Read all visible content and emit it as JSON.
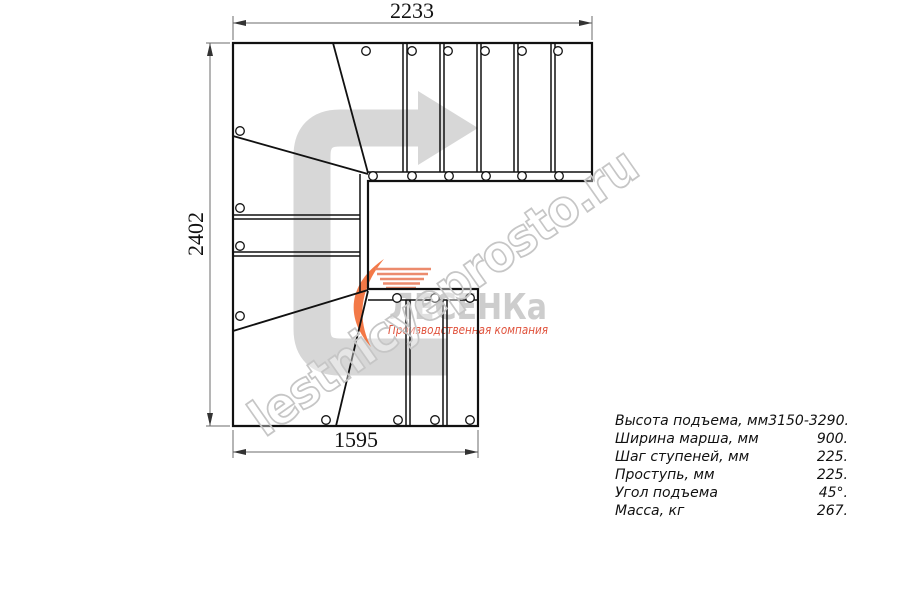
{
  "drawing": {
    "title": "L/U-shaped staircase plan with winder steps",
    "dim_top": "2233",
    "dim_left": "2402",
    "dim_bottom": "1595"
  },
  "watermark": {
    "text": "lestnicyeprosto.ru"
  },
  "logo": {
    "brand": "ЛЕСЕНКа",
    "tagline": "Производственная компания"
  },
  "specs": {
    "rows": [
      {
        "label": "Высота подъема, мм",
        "value": "3150-3290."
      },
      {
        "label": "Ширина марша, мм",
        "value": "900."
      },
      {
        "label": "Шаг ступеней, мм",
        "value": "225."
      },
      {
        "label": "Проступь, мм",
        "value": "225."
      },
      {
        "label": "Угол подъема",
        "value": "45°."
      },
      {
        "label": "Масса, кг",
        "value": "267."
      }
    ]
  },
  "colors": {
    "line_black": "#111111",
    "dim_gray": "#6b6b6b",
    "arrow_gray": "#d7d7d7",
    "watermark_gray": "#c6c6c6",
    "logo_gray": "#cdcdcd",
    "accent_orange": "#f26a33",
    "tagline_red": "#e0523c"
  }
}
